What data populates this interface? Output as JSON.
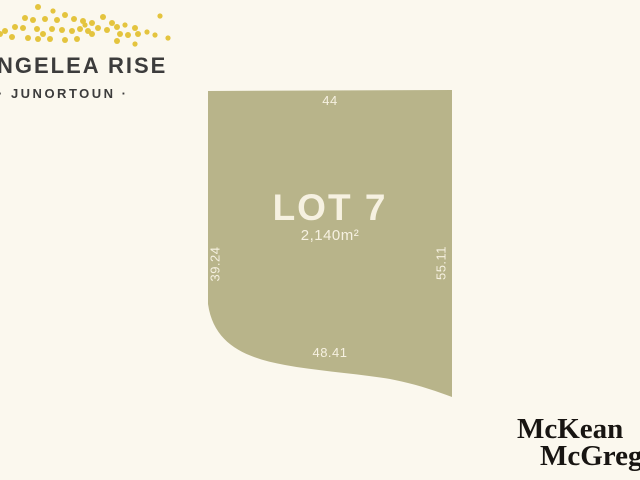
{
  "estate_logo": {
    "name_line": "NGELEA RISE",
    "location_line": "· JUNORTOUN ·",
    "dot_color": "#e4c43e",
    "dots": [
      [
        38,
        5,
        3
      ],
      [
        53,
        9,
        2.6
      ],
      [
        103,
        15,
        3
      ],
      [
        160,
        14,
        2.6
      ],
      [
        25,
        16,
        3
      ],
      [
        33,
        18,
        3
      ],
      [
        45,
        17,
        3
      ],
      [
        57,
        18,
        3
      ],
      [
        65,
        13,
        3
      ],
      [
        74,
        17,
        3
      ],
      [
        83,
        19,
        3
      ],
      [
        92,
        21,
        3
      ],
      [
        85,
        23,
        2.6
      ],
      [
        112,
        21,
        3
      ],
      [
        117,
        25,
        3
      ],
      [
        125,
        23,
        2.6
      ],
      [
        135,
        26,
        3
      ],
      [
        15,
        25,
        3
      ],
      [
        5,
        29,
        3
      ],
      [
        0,
        32,
        3
      ],
      [
        23,
        26,
        3
      ],
      [
        37,
        27,
        3
      ],
      [
        43,
        32,
        3
      ],
      [
        52,
        27,
        3
      ],
      [
        62,
        28,
        3
      ],
      [
        72,
        29,
        3
      ],
      [
        80,
        27,
        3
      ],
      [
        88,
        29,
        3
      ],
      [
        98,
        26,
        3
      ],
      [
        107,
        28,
        3
      ],
      [
        92,
        32,
        3
      ],
      [
        120,
        32,
        3
      ],
      [
        128,
        33,
        3
      ],
      [
        138,
        32,
        3
      ],
      [
        147,
        30,
        2.6
      ],
      [
        155,
        33,
        2.6
      ],
      [
        168,
        36,
        2.6
      ],
      [
        12,
        35,
        3
      ],
      [
        28,
        36,
        3
      ],
      [
        38,
        37,
        3
      ],
      [
        50,
        37,
        3
      ],
      [
        65,
        38,
        3
      ],
      [
        77,
        37,
        3
      ],
      [
        117,
        39,
        3
      ],
      [
        135,
        42,
        2.6
      ]
    ]
  },
  "lot": {
    "title": "LOT 7",
    "area": "2,140m²",
    "dimensions": {
      "top": "44",
      "left": "39.24",
      "right": "55.11",
      "bottom": "48.41"
    }
  },
  "agency_logo": {
    "line1": "McKean",
    "line2": "McGregor"
  },
  "colors": {
    "background": "#fbf8ee",
    "lot_fill": "#b8b48a",
    "lot_text": "#f6f1e1",
    "logo_text": "#3c3c3c",
    "agency_text": "#181512",
    "dot_color": "#e4c43e"
  }
}
